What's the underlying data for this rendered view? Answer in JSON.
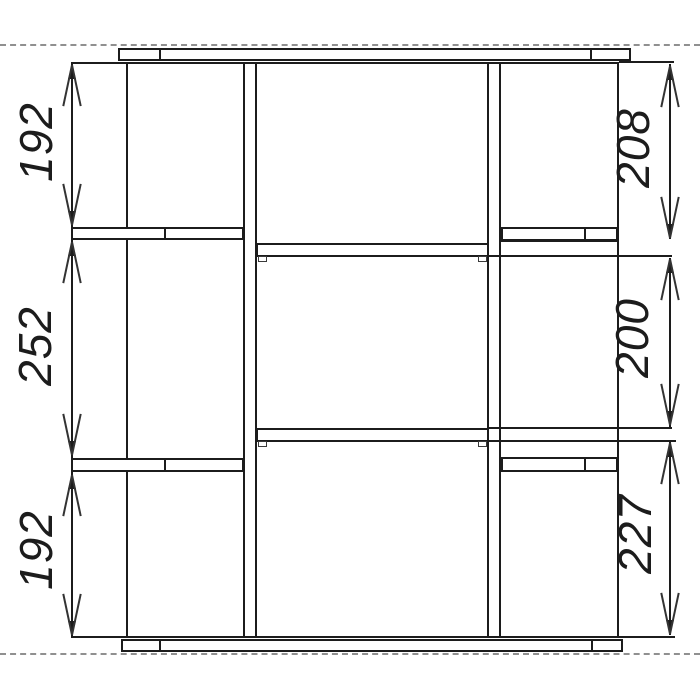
{
  "dimensions": {
    "left": [
      "192",
      "252",
      "192"
    ],
    "right": [
      "208",
      "200",
      "227"
    ]
  },
  "colors": {
    "line": "#1c1c1c",
    "dashed_guide": "#909090",
    "background": "#ffffff"
  }
}
